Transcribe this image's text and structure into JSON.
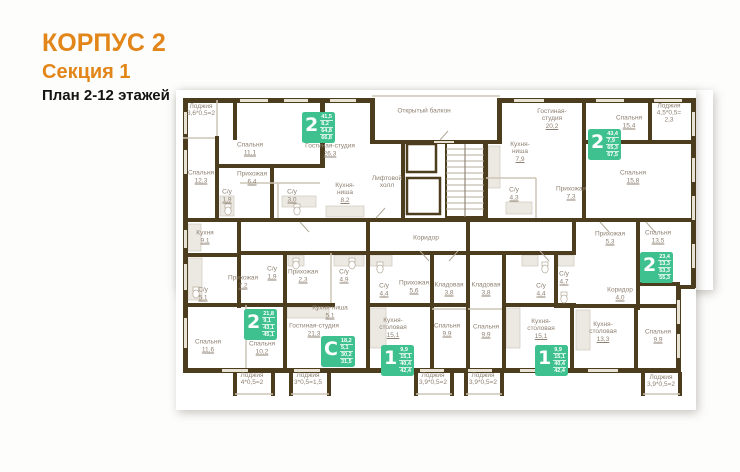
{
  "header": {
    "building": "КОРПУС 2",
    "section": "Секция 1",
    "plan_label": "План 2-12 этажей"
  },
  "colors": {
    "accent_orange": "#E2861A",
    "badge_green": "#3EC18E",
    "wall_brown": "#4C3D1E",
    "label_gray": "#8F8172"
  },
  "plan": {
    "rooms": [
      {
        "lines": [
          "Лоджия",
          "3,6*0,5=2"
        ],
        "area": "",
        "x": 201,
        "y": 110
      },
      {
        "lines": [
          "Спальня"
        ],
        "area": "11,1",
        "x": 250,
        "y": 149
      },
      {
        "lines": [
          "Гостиная-студия"
        ],
        "area": "26,3",
        "x": 330,
        "y": 150
      },
      {
        "lines": [
          "Спальня"
        ],
        "area": "12,3",
        "x": 201,
        "y": 177
      },
      {
        "lines": [
          "Прихожая"
        ],
        "area": "6,4",
        "x": 252,
        "y": 178
      },
      {
        "lines": [
          "С/у"
        ],
        "area": "1,9",
        "x": 227,
        "y": 196
      },
      {
        "lines": [
          "С/у"
        ],
        "area": "3,0",
        "x": 292,
        "y": 196
      },
      {
        "lines": [
          "Кухня-",
          "ниша"
        ],
        "area": "8,2",
        "x": 345,
        "y": 193
      },
      {
        "lines": [
          "Открытый  балкон"
        ],
        "area": "",
        "x": 424,
        "y": 111
      },
      {
        "lines": [
          "Гостиная-",
          "студия"
        ],
        "area": "20,2",
        "x": 552,
        "y": 119
      },
      {
        "lines": [
          "Кухня-",
          "ниша"
        ],
        "area": "7,9",
        "x": 520,
        "y": 152
      },
      {
        "lines": [
          "С/у"
        ],
        "area": "4,3",
        "x": 514,
        "y": 194
      },
      {
        "lines": [
          "Прихожая"
        ],
        "area": "7,3",
        "x": 571,
        "y": 193
      },
      {
        "lines": [
          "Лоджия",
          "4,5*0,5=",
          "2,3"
        ],
        "area": "",
        "x": 669,
        "y": 113
      },
      {
        "lines": [
          "Спальня"
        ],
        "area": "15,4",
        "x": 629,
        "y": 122
      },
      {
        "lines": [
          "Спальня"
        ],
        "area": "15,8",
        "x": 633,
        "y": 177
      },
      {
        "lines": [
          "Лифтовой",
          "холл"
        ],
        "area": "",
        "x": 387,
        "y": 182
      },
      {
        "lines": [
          "Коридор"
        ],
        "area": "",
        "x": 426,
        "y": 238
      },
      {
        "lines": [
          "Кухня"
        ],
        "area": "9,1",
        "x": 205,
        "y": 237
      },
      {
        "lines": [
          "С/у"
        ],
        "area": "5,1",
        "x": 203,
        "y": 294
      },
      {
        "lines": [
          "Прихожая"
        ],
        "area": "7,2",
        "x": 243,
        "y": 282
      },
      {
        "lines": [
          "С/у"
        ],
        "area": "1,9",
        "x": 272,
        "y": 273
      },
      {
        "lines": [
          "Прихожая"
        ],
        "area": "2,3",
        "x": 303,
        "y": 276
      },
      {
        "lines": [
          "С/у"
        ],
        "area": "4,9",
        "x": 344,
        "y": 276
      },
      {
        "lines": [
          "Кухня-ниша"
        ],
        "area": "5,1",
        "x": 330,
        "y": 312
      },
      {
        "lines": [
          "Гостиная-студия"
        ],
        "area": "21,3",
        "x": 314,
        "y": 330
      },
      {
        "lines": [
          "Спальня"
        ],
        "area": "11,6",
        "x": 208,
        "y": 346
      },
      {
        "lines": [
          "Спальня"
        ],
        "area": "10,2",
        "x": 262,
        "y": 348
      },
      {
        "lines": [
          "Лоджия",
          "4*0,5=2"
        ],
        "area": "",
        "x": 252,
        "y": 379
      },
      {
        "lines": [
          "Лоджия",
          "3*0,5=1,5"
        ],
        "area": "",
        "x": 308,
        "y": 379
      },
      {
        "lines": [
          "С/у"
        ],
        "area": "4,4",
        "x": 384,
        "y": 290
      },
      {
        "lines": [
          "Прихожая"
        ],
        "area": "5,6",
        "x": 414,
        "y": 287
      },
      {
        "lines": [
          "Кладовая"
        ],
        "area": "3,8",
        "x": 449,
        "y": 289
      },
      {
        "lines": [
          "Кладовая"
        ],
        "area": "3,8",
        "x": 486,
        "y": 289
      },
      {
        "lines": [
          "Кухня-",
          "столовая"
        ],
        "area": "15,1",
        "x": 393,
        "y": 328
      },
      {
        "lines": [
          "Спальня"
        ],
        "area": "9,9",
        "x": 447,
        "y": 330
      },
      {
        "lines": [
          "Спальня"
        ],
        "area": "9,9",
        "x": 486,
        "y": 331
      },
      {
        "lines": [
          "Лоджия",
          "3,9*0,5=2"
        ],
        "area": "",
        "x": 433,
        "y": 379
      },
      {
        "lines": [
          "Лоджия",
          "3,9*0,5=2"
        ],
        "area": "",
        "x": 483,
        "y": 379
      },
      {
        "lines": [
          "С/у"
        ],
        "area": "4,4",
        "x": 541,
        "y": 290
      },
      {
        "lines": [
          "Кухня-",
          "столовая"
        ],
        "area": "15,1",
        "x": 541,
        "y": 329
      },
      {
        "lines": [
          "Прихожая"
        ],
        "area": "5,3",
        "x": 610,
        "y": 238
      },
      {
        "lines": [
          "Спальня"
        ],
        "area": "13,5",
        "x": 658,
        "y": 237
      },
      {
        "lines": [
          "С/у"
        ],
        "area": "4,7",
        "x": 564,
        "y": 278
      },
      {
        "lines": [
          "Коридор"
        ],
        "area": "4,0",
        "x": 620,
        "y": 294
      },
      {
        "lines": [
          "Кухня-",
          "столовая"
        ],
        "area": "13,3",
        "x": 603,
        "y": 332
      },
      {
        "lines": [
          "Спальня"
        ],
        "area": "9,9",
        "x": 658,
        "y": 336
      },
      {
        "lines": [
          "Лоджия",
          "3,9*0,5=2"
        ],
        "area": "",
        "x": 661,
        "y": 381
      }
    ],
    "badges": [
      {
        "type": "2",
        "areas": [
          "41,5",
          "8,2",
          "64,8",
          "66,8"
        ],
        "x": 302,
        "y": 112
      },
      {
        "type": "2",
        "areas": [
          "43,4",
          "7,9",
          "65,3",
          "67,5"
        ],
        "x": 588,
        "y": 129
      },
      {
        "type": "2",
        "areas": [
          "23,4",
          "13,3",
          "53,3",
          "55,3"
        ],
        "x": 640,
        "y": 252
      },
      {
        "type": "2",
        "areas": [
          "21,8",
          "9,1",
          "43,1",
          "45,1"
        ],
        "x": 244,
        "y": 309
      },
      {
        "type": "С",
        "areas": [
          "18,2",
          "5,1",
          "30,2",
          "31,5"
        ],
        "x": 321,
        "y": 336
      },
      {
        "type": "1",
        "areas": [
          "9,9",
          "15,1",
          "40,4",
          "42,4"
        ],
        "x": 381,
        "y": 345
      },
      {
        "type": "1",
        "areas": [
          "9,9",
          "15,1",
          "40,4",
          "42,4"
        ],
        "x": 535,
        "y": 345
      }
    ]
  }
}
